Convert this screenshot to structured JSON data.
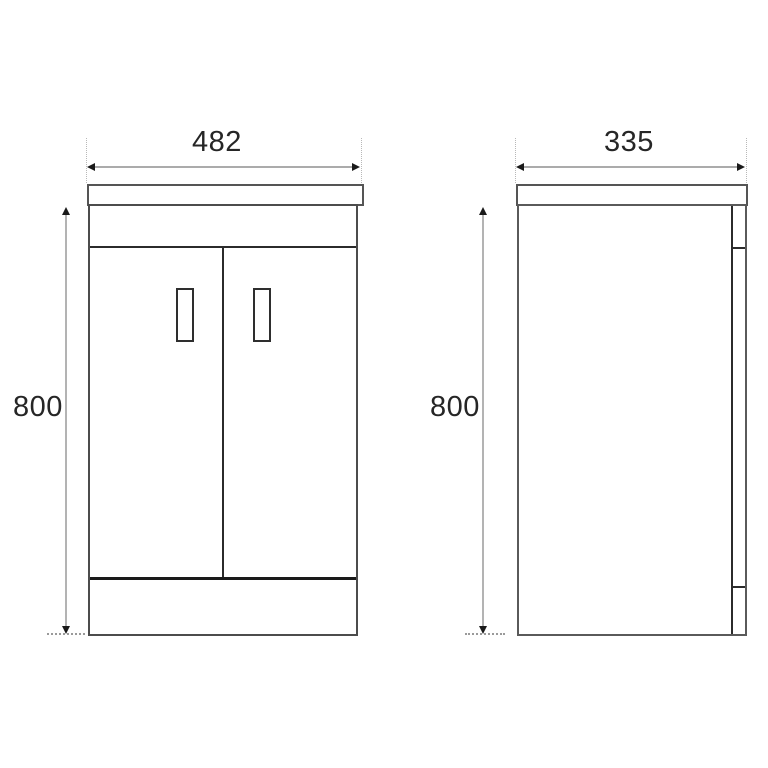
{
  "drawing": {
    "type": "technical-dimension-drawing",
    "subject": "vanity-unit-two-door-cabinet",
    "front_view": {
      "width_label": "482",
      "height_label": "800"
    },
    "side_view": {
      "depth_label": "335",
      "height_label": "800"
    },
    "colors": {
      "background": "#ffffff",
      "cabinet_outline": "#4c4c4c",
      "internal_line": "#2b2b2b",
      "dimension_line": "#ababab",
      "arrowhead": "#1a1a1a",
      "label_text": "#262626"
    }
  }
}
